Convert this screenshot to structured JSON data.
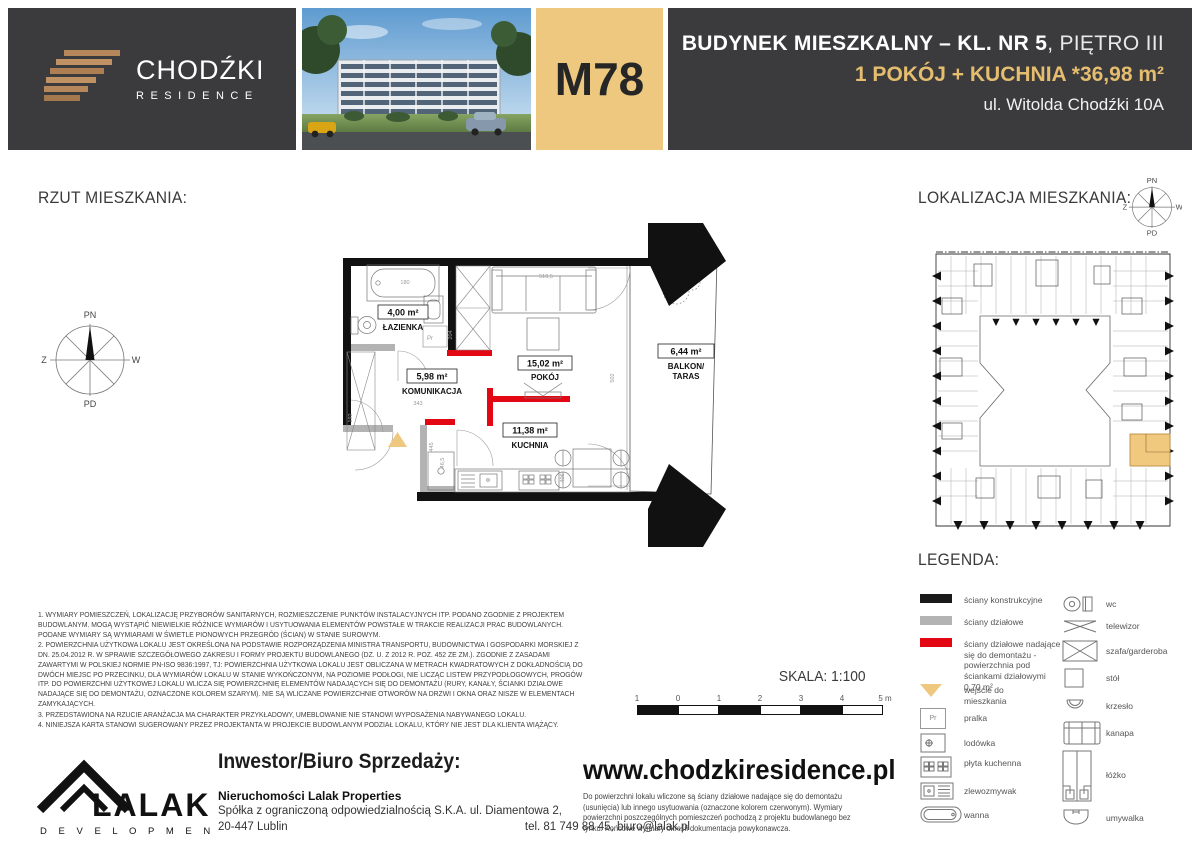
{
  "header": {
    "brand": {
      "title": "CHODŹKI",
      "subtitle": "RESIDENCE"
    },
    "unit_code": "M78",
    "building_title_bold": "BUDYNEK MIESZKALNY – KL. NR 5",
    "building_title_light": ", PIĘTRO III",
    "unit_summary": "1 POKÓJ + KUCHNIA *36,98 m²",
    "address": "ul. Witolda Chodźki 10A"
  },
  "plan": {
    "section_title": "RZUT MIESZKANIA:",
    "compass": {
      "north": "PN",
      "south": "PD",
      "west": "Z",
      "east": "W"
    },
    "rooms": [
      {
        "area": "4,00 m²",
        "name": "ŁAZIENKA"
      },
      {
        "area": "5,98 m²",
        "name": "KOMUNIKACJA"
      },
      {
        "area": "15,02 m²",
        "name": "POKÓJ"
      },
      {
        "area": "11,38 m²",
        "name": "KUCHNIA"
      },
      {
        "area": "6,44 m²",
        "name": "BALKON/",
        "name2": "TARAS"
      }
    ],
    "dims": {
      "tub": "180",
      "sofa": "510,5",
      "bath_wall": "204",
      "room": "502",
      "hall": "343",
      "entry": "192",
      "counter": "406",
      "nook": "445",
      "fridge": "46,5"
    },
    "washer": "Pr"
  },
  "location": {
    "section_title": "LOKALIZACJA MIESZKANIA:",
    "compass": {
      "north": "PN",
      "south": "PD",
      "west": "Z",
      "east": "W"
    }
  },
  "notes": [
    "1. WYMIARY POMIESZCZEŃ, LOKALIZACJĘ PRZYBORÓW SANITARNYCH, ROZMIESZCZENIE PUNKTÓW INSTALACYJNYCH ITP. PODANO ZGODNIE Z PROJEKTEM BUDOWLANYM. MOGĄ WYSTĄPIĆ NIEWIELKIE RÓŻNICE WYMIARÓW I USYTUOWANIA ELEMENTÓW POWSTAŁE W TRAKCIE REALIZACJI PRAC BUDOWLANYCH. PODANE WYMIARY SĄ WYMIARAMI W ŚWIETLE PIONOWYCH PRZEGRÓD (ŚCIAN) W STANIE SUROWYM.",
    "2. POWIERZCHNIA UŻYTKOWA LOKALU JEST OKREŚLONA NA PODSTAWIE ROZPORZĄDZENIA MINISTRA TRANSPORTU, BUDOWNICTWA I GOSPODARKI MORSKIEJ Z DN. 25.04.2012 R. W SPRAWIE SZCZEGÓŁOWEGO ZAKRESU I FORMY PROJEKTU BUDOWLANEGO (DZ. U. Z 2012 R. POZ. 452 ZE ZM.). ZGODNIE Z ZASADAMI ZAWARTYMI W POLSKIEJ NORMIE PN-ISO 9836:1997, TJ: POWIERZCHNIA UŻYTKOWA LOKALU JEST OBLICZANA W METRACH KWADRATOWYCH Z DOKŁADNOŚCIĄ DO DWÓCH MIEJSC PO PRZECINKU, DLA WYMIARÓW LOKALU W STANIE WYKOŃCZONYM, NA POZIOMIE PODŁOGI, NIE LICZĄC LISTEW PRZYPODŁOGOWYCH, PROGÓW ITP. DO POWIERZCHNI UŻYTKOWEJ LOKALU WLICZA SIĘ POWIERZCHNIĘ ELEMENTÓW NADAJĄCYCH SIĘ DO DEMONTAŻU (RURY, KANAŁY, ŚCIANKI DZIAŁOWE NADAJĄCE SIĘ DO DEMONTAŻU, OZNACZONE KOLOREM SZARYM). NIE SĄ WLICZANE POWIERZCHNIE OTWORÓW NA DRZWI I OKNA ORAZ NISZE W ELEMENTACH ZAMYKAJĄCYCH.",
    "3. PRZEDSTAWIONA NA RZUCIE ARANŻACJA MA CHARAKTER PRZYKŁADOWY, UMEBLOWANIE NIE STANOWI WYPOSAŻENIA NABYWANEGO LOKALU.",
    "4. NINIEJSZA KARTA STANOWI SUGEROWANY PRZEZ PROJEKTANTA W PROJEKCIE BUDOWLANYM PODZIAŁ LOKALU, KTÓRY NIE JEST DLA KLIENTA WIĄŻĄCY."
  ],
  "scale": {
    "label": "SKALA: 1:100",
    "ticks": [
      "1",
      "0",
      "1",
      "2",
      "3",
      "4",
      "5 m"
    ]
  },
  "legend": {
    "title": "LEGENDA:",
    "left": [
      {
        "label": "ściany konstrukcyjne"
      },
      {
        "label": "ściany działowe"
      },
      {
        "label": "ściany działowe nadające się do demontażu - powierzchnia pod ściankami działowymi 0,70 m²"
      },
      {
        "label": "wejście do mieszkania"
      },
      {
        "label": "pralka",
        "glyph": "Pr"
      },
      {
        "label": "lodówka"
      },
      {
        "label": "płyta kuchenna"
      },
      {
        "label": "zlewozmywak"
      },
      {
        "label": "wanna"
      }
    ],
    "right": [
      {
        "label": "wc"
      },
      {
        "label": "telewizor"
      },
      {
        "label": "szafa/garderoba"
      },
      {
        "label": "stół"
      },
      {
        "label": "krzesło"
      },
      {
        "label": "kanapa"
      },
      {
        "label": "łóżko"
      },
      {
        "label": "umywalka"
      }
    ]
  },
  "footer": {
    "logo_title": "LALAK",
    "logo_subtitle": "D E V E L O P M E N T",
    "investor_heading": "Inwestor/Biuro Sprzedaży:",
    "company": "Nieruchomości Lalak Properties",
    "company_address": "Spółka z ograniczoną odpowiedzialnością S.K.A. ul. Diamentowa 2,",
    "company_city": "20-447 Lublin",
    "company_contact": "tel. 81 749 88 45, biuro@lalak.pl",
    "website": "www.chodzkiresidence.pl",
    "website_note": "Do powierzchni lokalu wliczone są ściany działowe nadające się do demontażu (usunięcia) lub innego usytuowania (oznaczone kolorem czerwonym). Wymiary powierzchni poszczególnych pomieszczeń pochodzą z projektu budowlanego bez tynku. Końcowe wymiary określi dokumentacja powykonawcza."
  },
  "colors": {
    "accent_gold": "#EDC87E",
    "wall_black": "#1A1A1A",
    "wall_gray": "#B3B3B3",
    "wall_red": "#E30613",
    "header_dark": "#3B3B3D"
  }
}
